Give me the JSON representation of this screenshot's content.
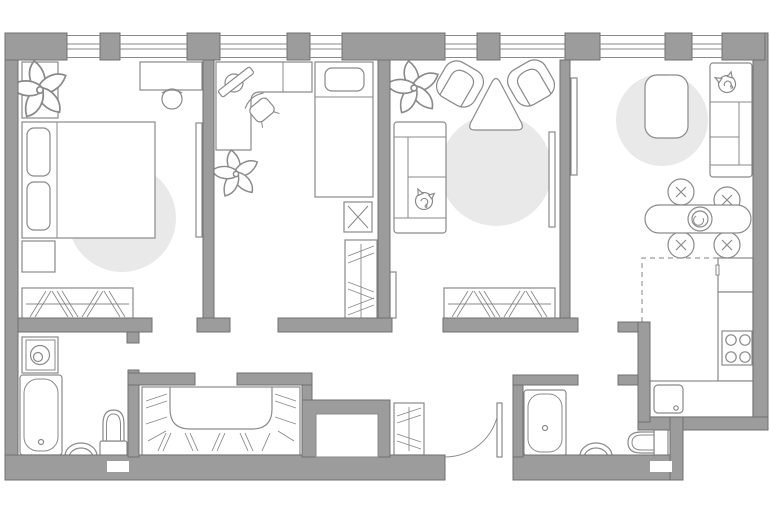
{
  "plan": {
    "kind": "apartment-floor-plan",
    "colors": {
      "wall": "#9c9c9c",
      "wall_outline": "#6f6f6f",
      "furniture_stroke": "#8a8a8a",
      "window_line": "#8a8a8a",
      "rug": "#e9e9e9",
      "dashed_zone": "#9a9a9a",
      "background": "#ffffff"
    },
    "windows": {
      "count": 8,
      "position": "top-wall"
    },
    "rooms": [
      {
        "id": "bedroom-1",
        "furniture": [
          "potted-plant",
          "planter-stand",
          "desk",
          "desk-chair",
          "double-bed",
          "pillow",
          "pillow",
          "nightstand",
          "round-rug",
          "wardrobe-hatched",
          "tv-panel"
        ]
      },
      {
        "id": "bedroom-2",
        "furniture": [
          "corner-desk",
          "keyboard-board",
          "office-chair",
          "potted-plant",
          "single-bed",
          "pillow",
          "nightstand-with-lamp",
          "wardrobe-hatched"
        ]
      },
      {
        "id": "living-room",
        "furniture": [
          "potted-plant",
          "armchair",
          "armchair",
          "triangle-coffee-table",
          "sofa",
          "cat",
          "round-rug",
          "wardrobe-hatched",
          "tv-panel",
          "open-door-leaf"
        ]
      },
      {
        "id": "kitchen-living-room",
        "furniture": [
          "tv-panel",
          "coffee-table",
          "round-rug",
          "sofa",
          "cat",
          "dining-table",
          "table-centerpiece",
          "dining-chair",
          "dining-chair",
          "dining-chair",
          "dining-chair",
          "fridge",
          "kitchen-counter",
          "stove-4-burner",
          "kitchen-sink",
          "kitchen-zone-dashed-line"
        ]
      },
      {
        "id": "bathroom-1",
        "furniture": [
          "washing-machine",
          "bathtub",
          "wash-sink",
          "toilet",
          "vent-grille"
        ]
      },
      {
        "id": "bathroom-2",
        "furniture": [
          "bathtub",
          "wash-sink",
          "toilet",
          "vent-grille"
        ]
      },
      {
        "id": "walk-in-closet",
        "furniture": [
          "u-shaped-wardrobe-hatched"
        ]
      },
      {
        "id": "hallway",
        "furniture": [
          "wardrobe-hatched",
          "utility-shaft",
          "entrance-door-swing"
        ]
      }
    ]
  }
}
